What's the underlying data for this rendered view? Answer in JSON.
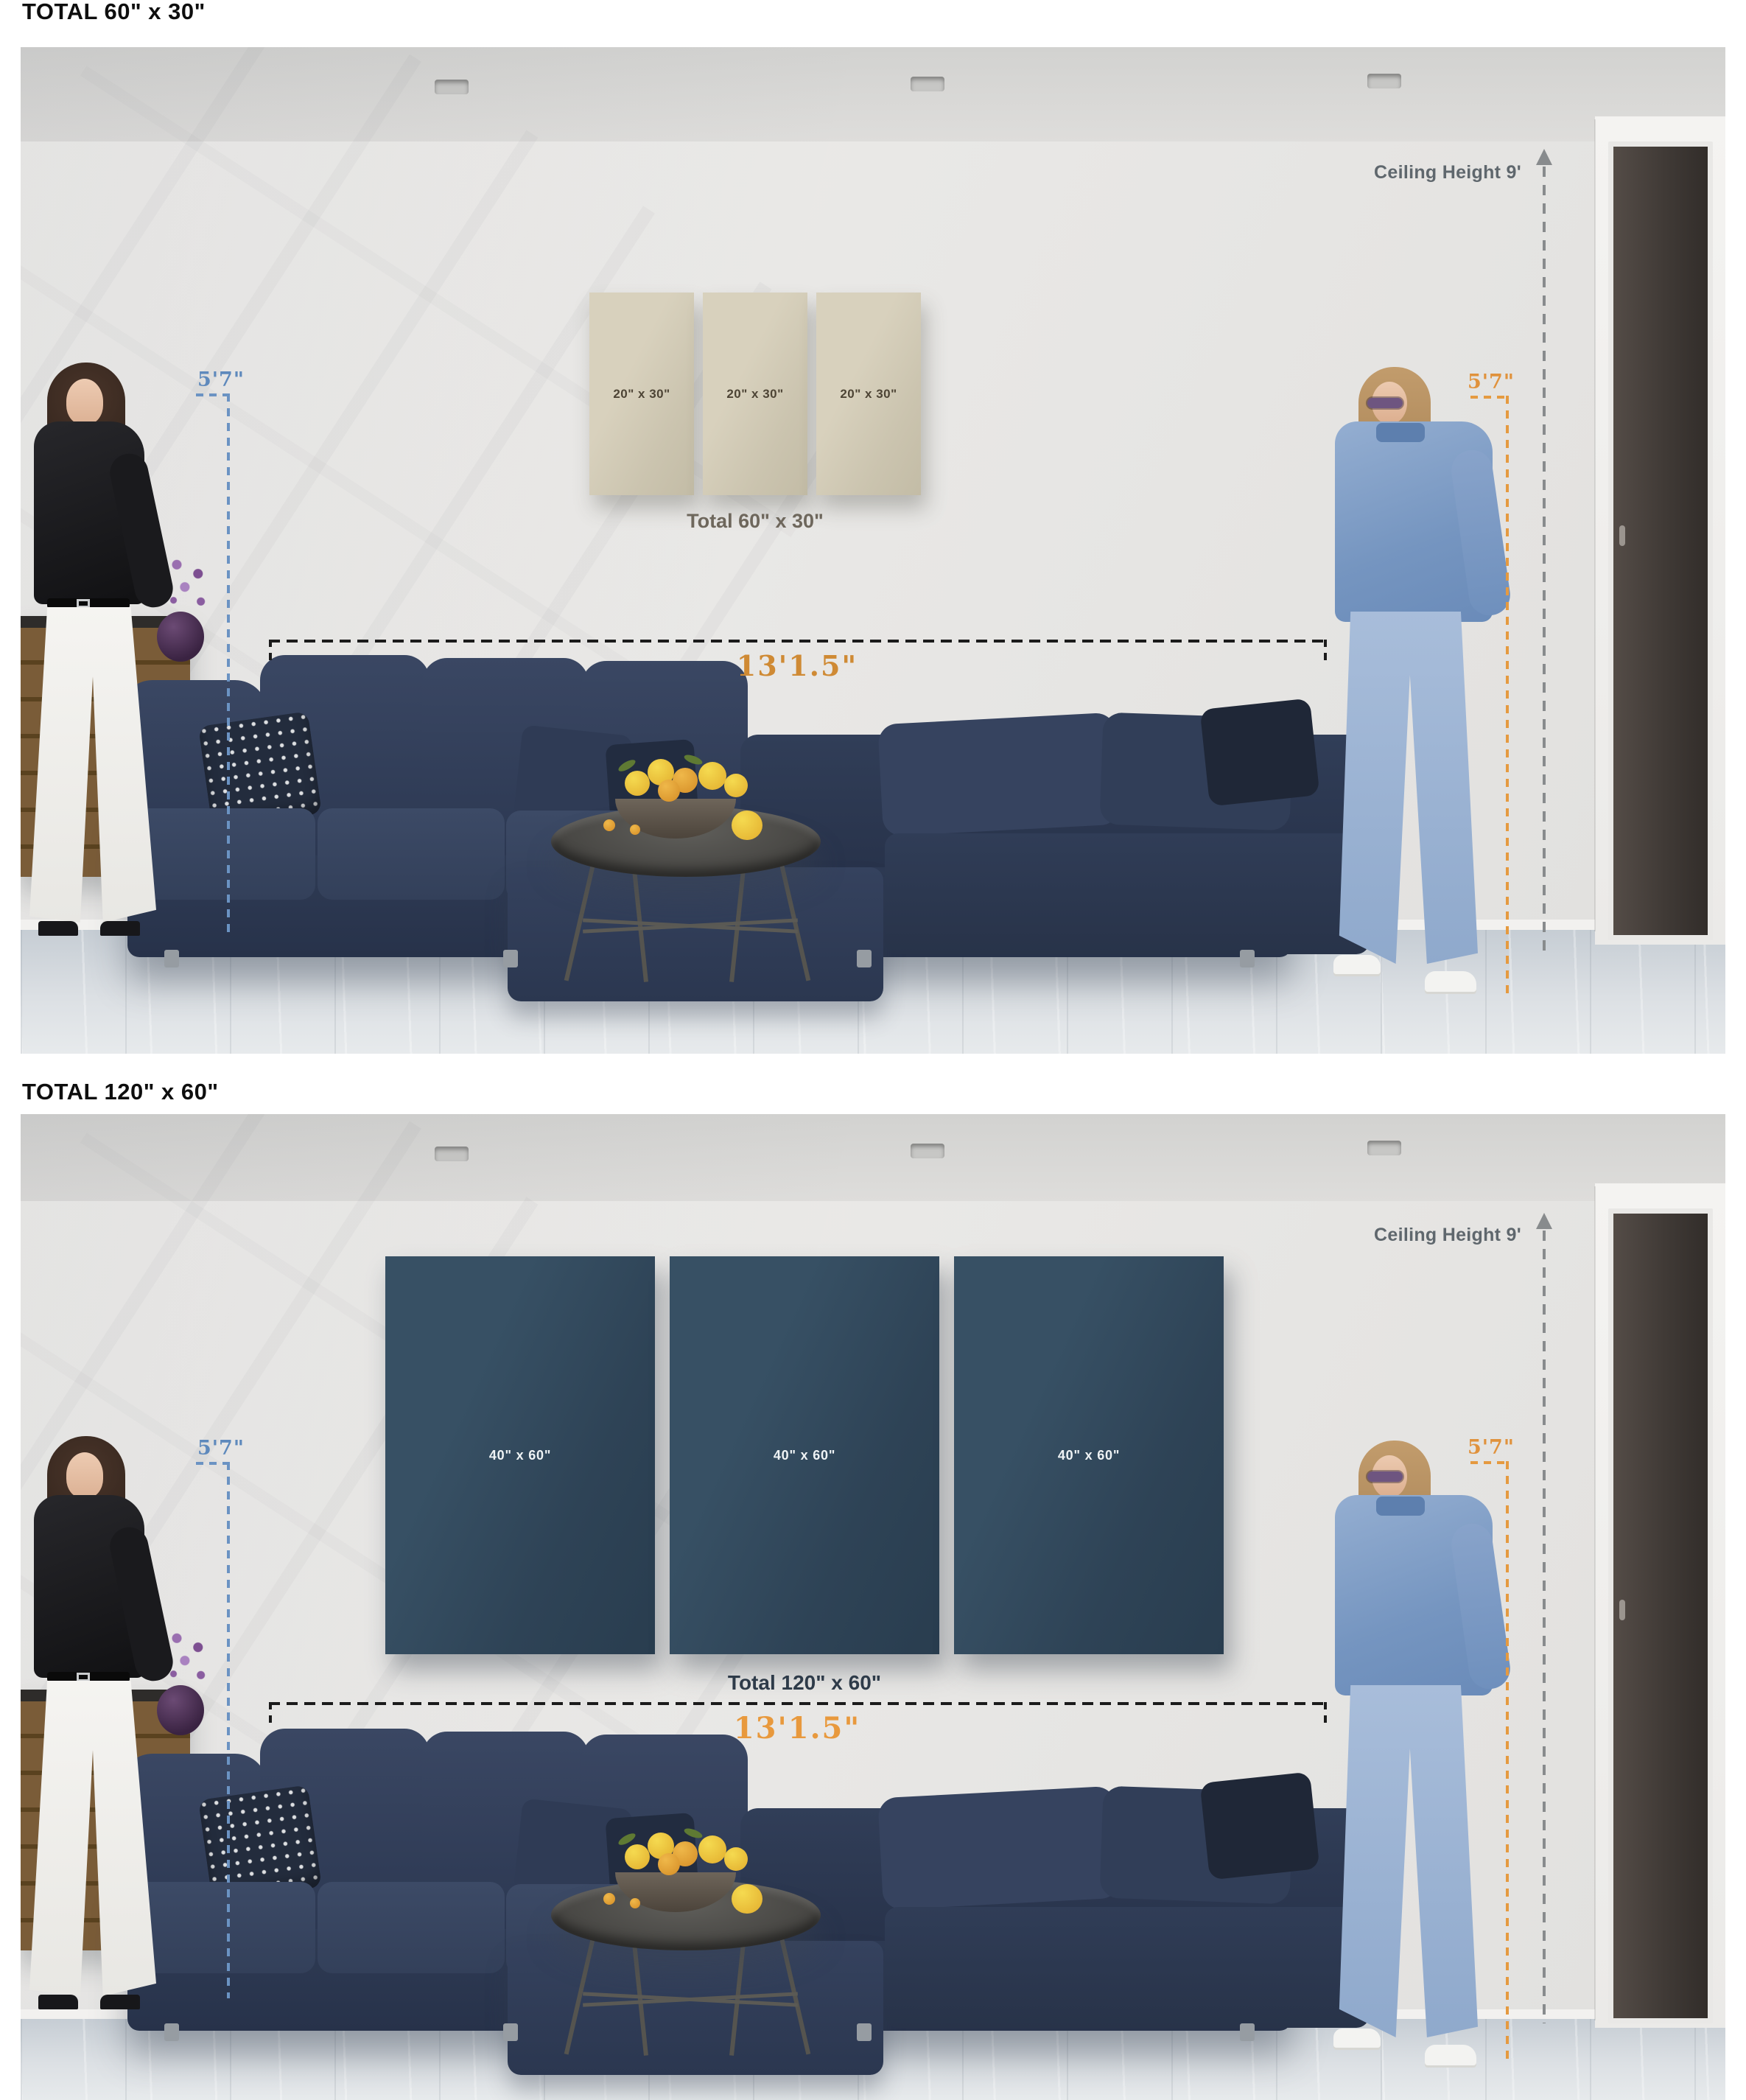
{
  "figures": [
    {
      "header": "TOTAL 60\" x 30\"",
      "panels": [
        {
          "label": "20\" x 30\""
        },
        {
          "label": "20\" x 30\""
        },
        {
          "label": "20\" x 30\""
        }
      ],
      "total_label": "Total 60\" x 30\"",
      "annotations": {
        "ceiling_height": "Ceiling Height 9'",
        "person_height_left": "5'7\"",
        "person_height_right": "5'7\"",
        "sofa_width": "13'1.5\""
      },
      "panel_color": "#d4cdb8",
      "panel_text_color": "#4d4435"
    },
    {
      "header": "TOTAL 120\" x 60\"",
      "panels": [
        {
          "label": "40\" x 60\""
        },
        {
          "label": "40\" x 60\""
        },
        {
          "label": "40\" x 60\""
        }
      ],
      "total_label": "Total 120\" x 60\"",
      "annotations": {
        "ceiling_height": "Ceiling Height 9'",
        "person_height_left": "5'7\"",
        "person_height_right": "5'7\"",
        "sofa_width": "13'1.5\""
      },
      "panel_color": "#33495c",
      "panel_text_color": "#f3f5f6"
    }
  ],
  "colors": {
    "accent_orange": "#e0923c",
    "accent_blue": "#5e89bc",
    "dimension_grey": "#5f676d",
    "dimension_black": "#1b1b1b",
    "total_text_scene1": "#6e675c",
    "total_text_scene2": "#2e3b49"
  }
}
